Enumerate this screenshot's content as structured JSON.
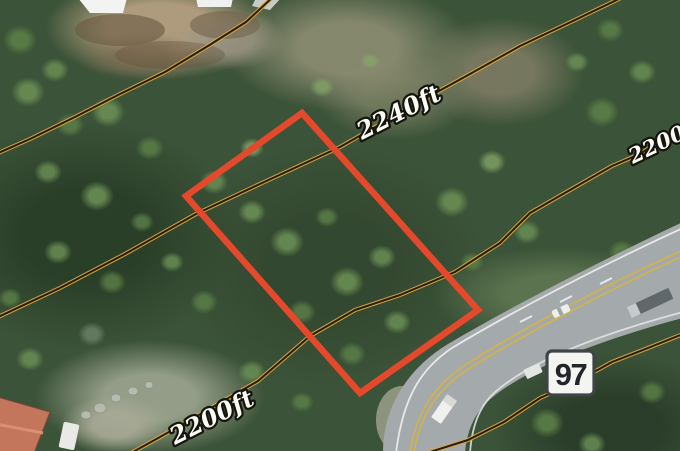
{
  "map": {
    "view": "aerial-satellite-with-topo-contours",
    "contour_labels": {
      "upper": "2240ft",
      "right": "2200ft",
      "lower_left": "2200ft"
    },
    "highway_shield": {
      "number": "97",
      "bg_color": "#f4f4f0",
      "border_color": "#3f4446"
    },
    "parcel": {
      "outline_color": "#e5492c"
    },
    "contours": {
      "line_color": "#221604",
      "halo_color": "#d7a844"
    }
  }
}
